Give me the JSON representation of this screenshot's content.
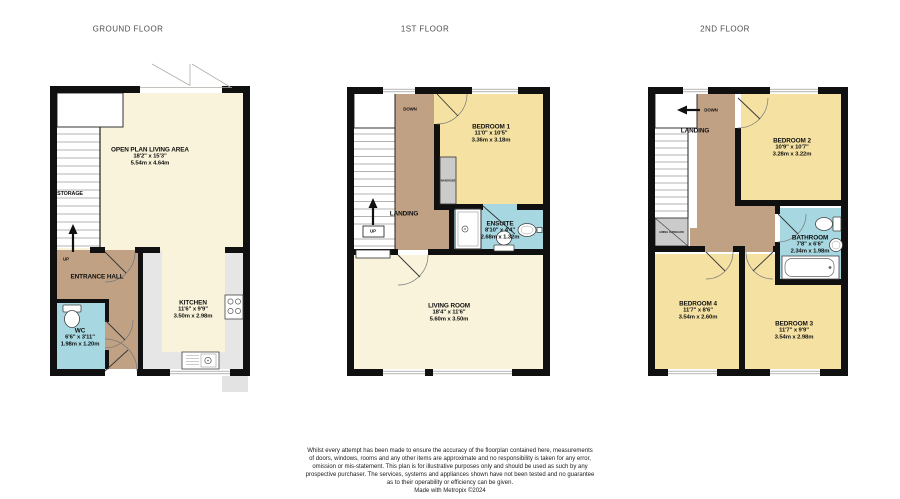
{
  "document": {
    "type": "property-floorplan"
  },
  "palette": {
    "wall": "#101010",
    "living_area": "#f8f3da",
    "bedroom": "#f5e2a3",
    "hallway": "#c0a184",
    "bathroom": "#a7d8e1",
    "kitchen_counter": "#e6e6e6",
    "cupboard": "#cbcbcb"
  },
  "floors": {
    "ground": {
      "title": "GROUND FLOOR",
      "living": {
        "name": "OPEN PLAN LIVING AREA",
        "ft": "18'2\" x 15'3\"",
        "m": "5.54m x 4.64m"
      },
      "storage": "STORAGE",
      "up": "UP",
      "hall": "ENTRANCE HALL",
      "wc": {
        "name": "WC",
        "ft": "6'6\" x 3'11\"",
        "m": "1.98m x 1.20m"
      },
      "kitchen": {
        "name": "KITCHEN",
        "ft": "11'6\" x 9'9\"",
        "m": "3.50m x 2.98m"
      }
    },
    "first": {
      "title": "1ST FLOOR",
      "down": "DOWN",
      "up": "UP",
      "landing": "LANDING",
      "wardrobe": "WARDROBE",
      "bedroom1": {
        "name": "BEDROOM 1",
        "ft": "11'0\" x 10'5\"",
        "m": "3.36m x 3.18m"
      },
      "ensuite": {
        "name": "ENSUITE",
        "ft": "8'10\" x 4'4\"",
        "m": "2.68m x 1.32m"
      },
      "living": {
        "name": "LIVING ROOM",
        "ft": "18'4\" x 11'6\"",
        "m": "5.60m x 3.50m"
      }
    },
    "second": {
      "title": "2ND FLOOR",
      "down": "DOWN",
      "landing": "LANDING",
      "airing_cupboard": "AIRING CUPBOARD",
      "bedroom2": {
        "name": "BEDROOM 2",
        "ft": "10'9\" x 10'7\"",
        "m": "3.28m x 3.22m"
      },
      "bathroom": {
        "name": "BATHROOM",
        "ft": "7'8\" x 6'6\"",
        "m": "2.34m x 1.98m"
      },
      "bedroom4": {
        "name": "BEDROOM 4",
        "ft": "11'7\" x 8'6\"",
        "m": "3.54m x 2.60m"
      },
      "bedroom3": {
        "name": "BEDROOM 3",
        "ft": "11'7\" x 9'9\"",
        "m": "3.54m x 2.98m"
      }
    }
  },
  "footer": {
    "line1": "Whilst every attempt has been made to ensure the accuracy of the floorplan contained here, measurements",
    "line2": "of doors, windows, rooms and any other items are approximate and no responsibility is taken for any error,",
    "line3": "omission or mis-statement. This plan is for illustrative purposes only and should be used as such by any",
    "line4": "prospective purchaser. The services, systems and appliances shown have not been tested and no guarantee",
    "line5": "as to their operability or efficiency can be given.",
    "credit": "Made with Metropix ©2024"
  }
}
